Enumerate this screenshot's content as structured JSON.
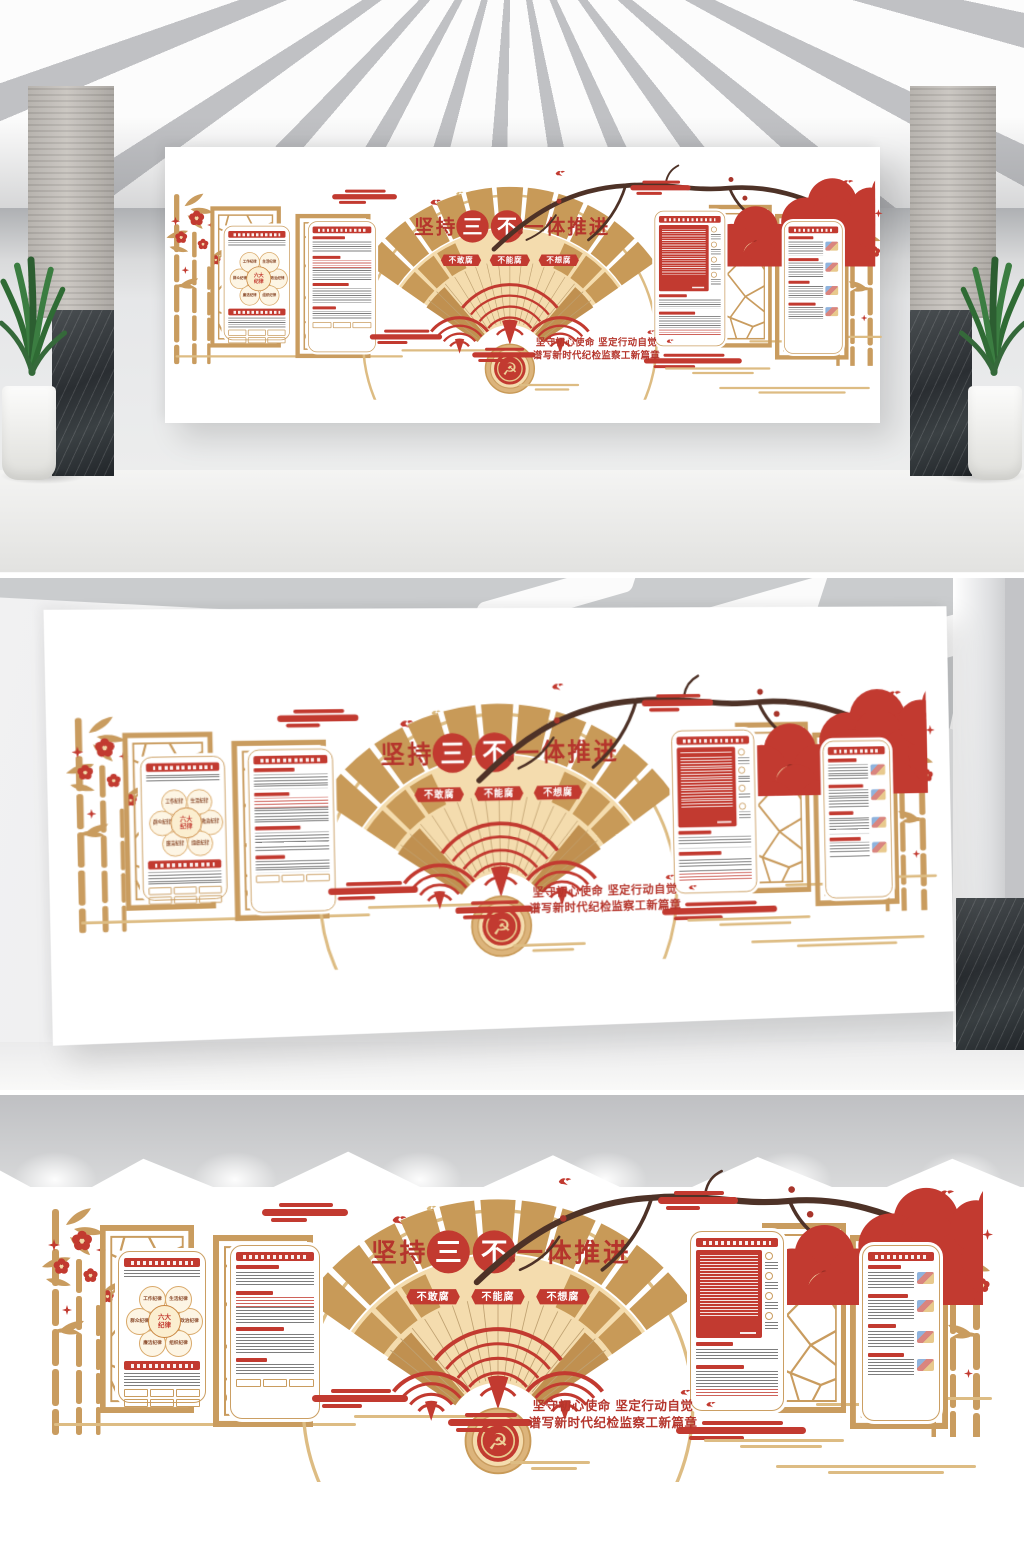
{
  "design": {
    "colors": {
      "red": "#c23a30",
      "deep-red": "#a93226",
      "text-red": "#b5352c",
      "gold": "#c99c5f",
      "light-gold": "#ddbc83",
      "cream": "#f4dcae",
      "tan": "#c89a58",
      "branch-brown": "#4e3227"
    },
    "fan": {
      "title_prefix": "坚持",
      "highlight_1": "三",
      "highlight_2": "不",
      "title_suffix": "一体推进",
      "ribbons": [
        "不敢腐",
        "不能腐",
        "不想腐"
      ],
      "emblem_glyph": "☭"
    },
    "banner": {
      "line1": "坚守初心使命 坚定行动自觉",
      "line2": "谱写新时代纪检监察工新篇章"
    },
    "diagram": {
      "center_line1": "六大",
      "center_line2": "纪律",
      "items": [
        "政治纪律",
        "组织纪律",
        "廉洁纪律",
        "群众纪律",
        "工作纪律",
        "生活纪律"
      ]
    }
  }
}
